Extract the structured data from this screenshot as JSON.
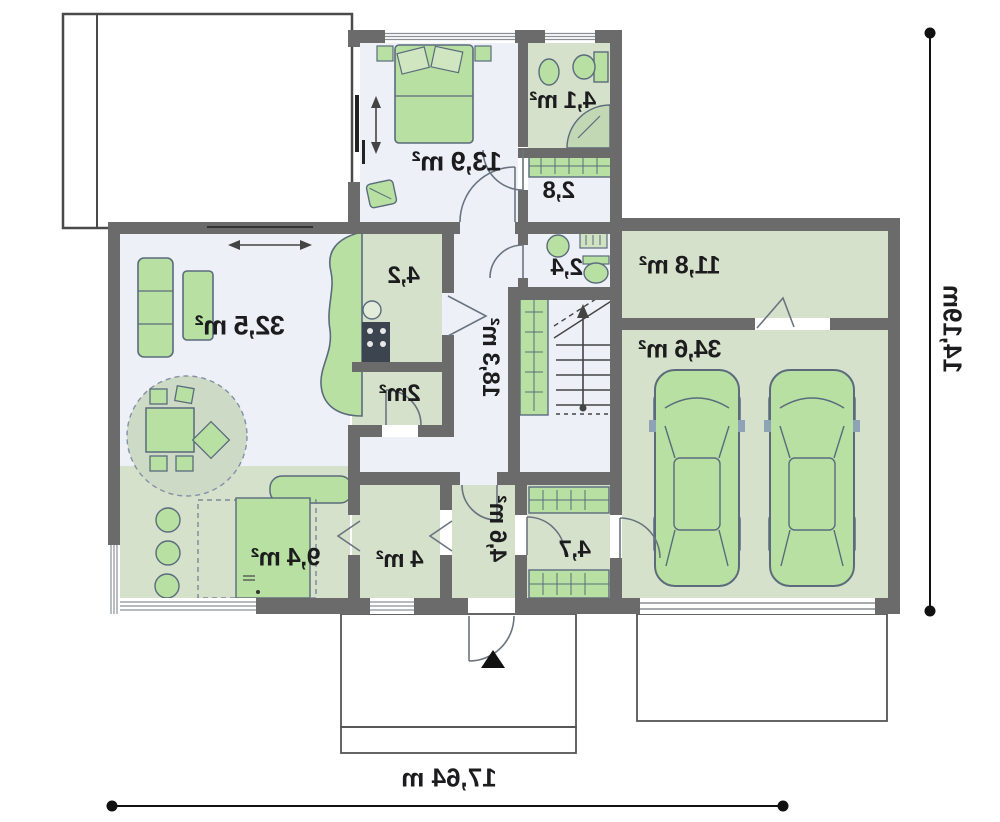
{
  "title": "ground-floor-plan",
  "labels": {
    "living_room": "32,5 m²",
    "bedroom": "13,9 m²",
    "bathroom": "4,1 m²",
    "corridor": "2,8",
    "kitchen": "4,2",
    "pantry": "2m²",
    "hall": "18,3 m²",
    "wc": "2,4",
    "storage": "11,8 m²",
    "garage": "34,6 m²",
    "terrace": "9,4 m²",
    "utility": "4 m²",
    "entry": "4,6 m²",
    "boiler": "4,7"
  },
  "dimensions": {
    "width": "17,64 m",
    "height": "14,19m"
  },
  "colors": {
    "wall": "#6b6b6b",
    "floor_light": "#edf1f7",
    "floor_green": "#d5e1cb",
    "furniture_green": "#b7e0a2",
    "rug_green": "#cddac5",
    "outline": "#5b6b7c",
    "text": "#1c1c1e",
    "dimension_line": "#111111"
  }
}
